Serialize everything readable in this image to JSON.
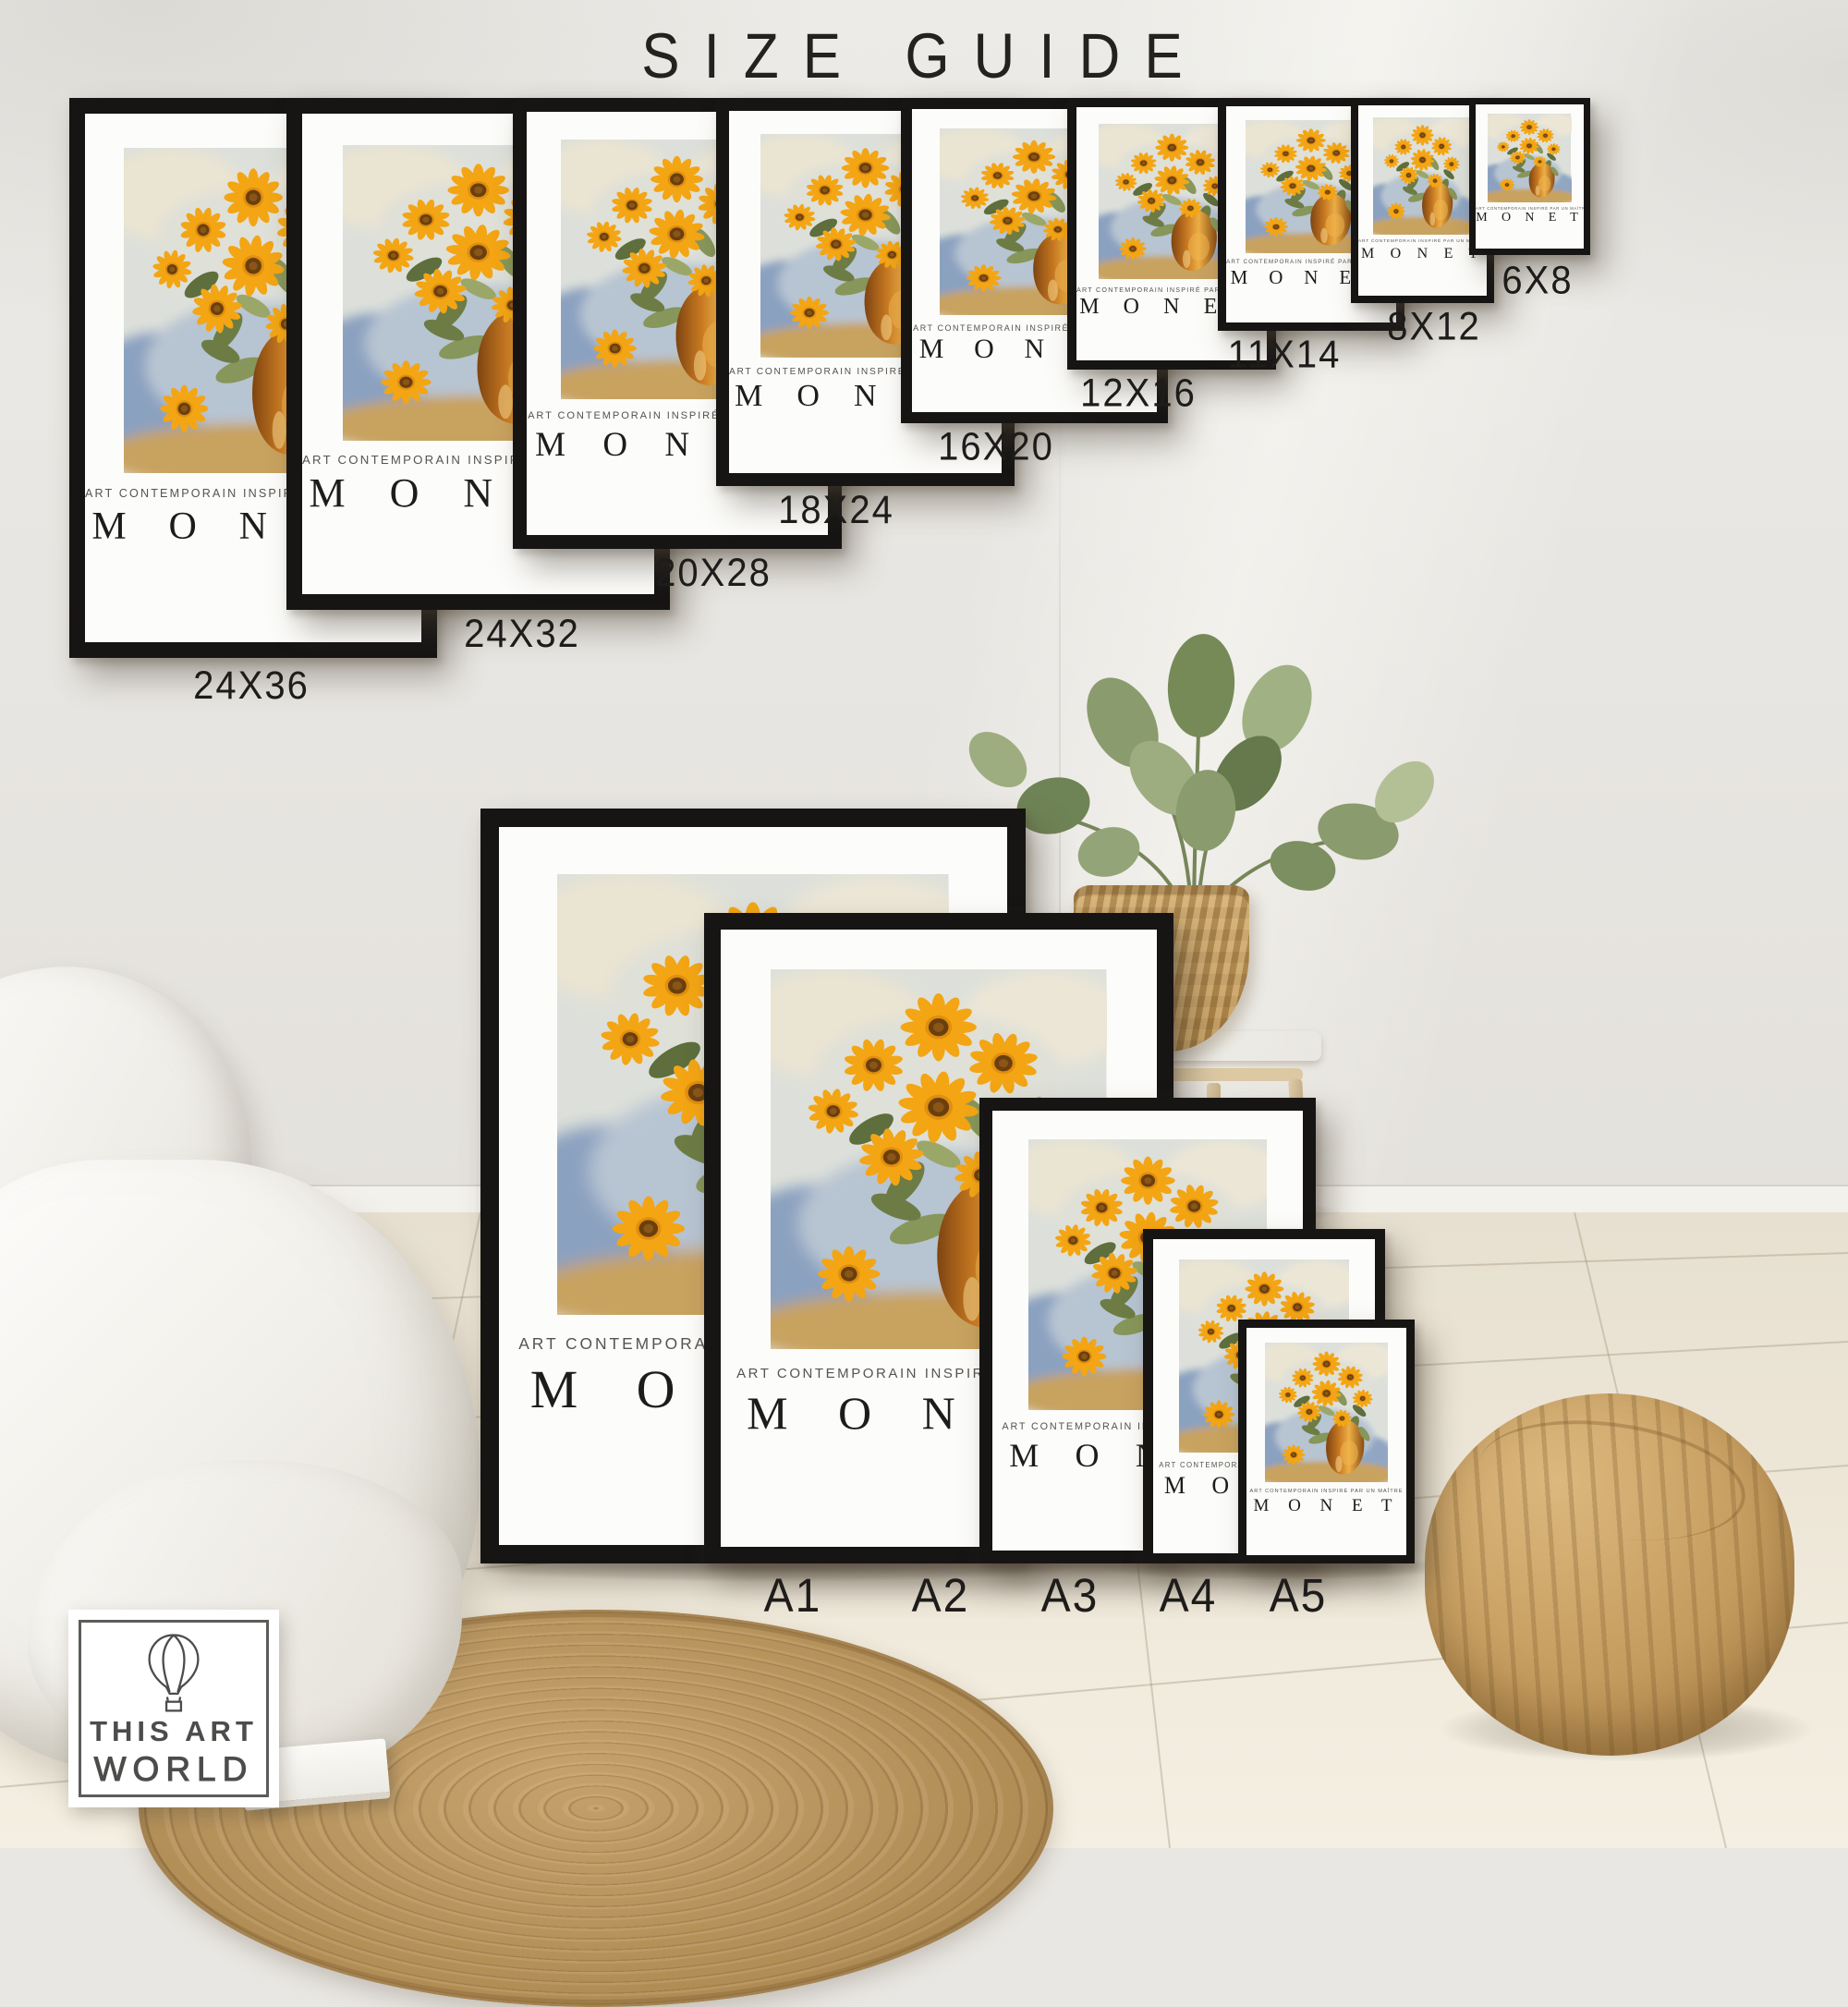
{
  "title": "SIZE GUIDE",
  "poster": {
    "subtitle": "ART CONTEMPORAIN INSPIRÉ PAR UN MAÎTRE",
    "artist": "M O N E T"
  },
  "top_row": [
    {
      "label": "24X36"
    },
    {
      "label": "24X32"
    },
    {
      "label": "20X28"
    },
    {
      "label": "18X24"
    },
    {
      "label": "16X20"
    },
    {
      "label": "12X16"
    },
    {
      "label": "11X14"
    },
    {
      "label": "8X12"
    },
    {
      "label": "6X8"
    }
  ],
  "bottom_row": [
    {
      "label": "A1"
    },
    {
      "label": "A2"
    },
    {
      "label": "A3"
    },
    {
      "label": "A4"
    },
    {
      "label": "A5"
    }
  ],
  "logo": {
    "line1": "THIS ART",
    "line2": "WORLD",
    "icon": "hot-air-balloon-icon"
  },
  "scene": {
    "artwork": "sunflowers-in-vase-oil-painting",
    "decor": [
      "white-bed",
      "round-jute-rug",
      "book",
      "fiddle-leaf-plant-in-basket",
      "wooden-bench",
      "jute-pouf"
    ]
  },
  "colors": {
    "wall": "#e9e7e3",
    "frame": "#161514",
    "mat": "#fcfcfa",
    "sunflower": "#f3a514",
    "flower_center": "#6b3f0d",
    "vase": "#c97a22",
    "jute": "#c59c5f",
    "floor": "#ece5d6",
    "text": "#1d1c1a"
  }
}
